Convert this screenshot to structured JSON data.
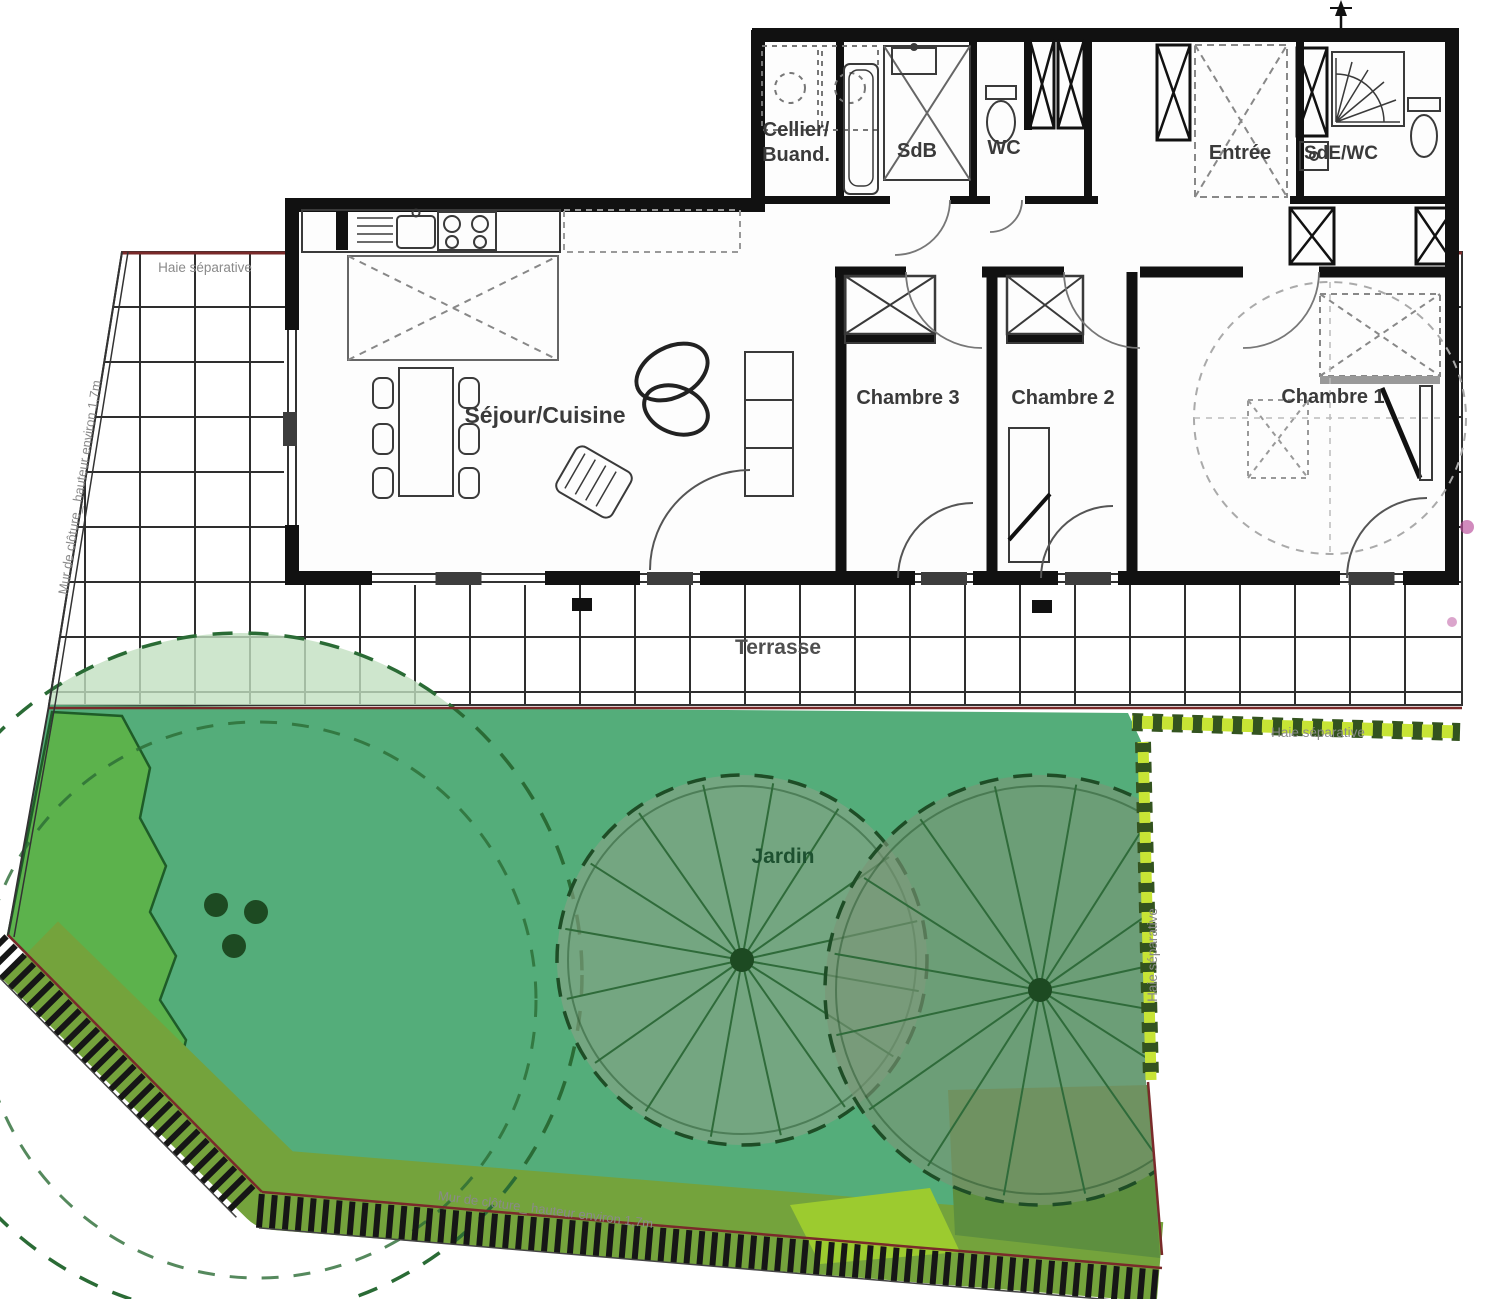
{
  "plan": {
    "labels": {
      "cellier_1": "Cellier/",
      "cellier_2": "Buand.",
      "sdb": "SdB",
      "wc": "WC",
      "entree": "Entrée",
      "sde_wc": "SdE/WC",
      "sejour": "Séjour/Cuisine",
      "chambre3": "Chambre 3",
      "chambre2": "Chambre 2",
      "chambre1": "Chambre 1",
      "terrasse": "Terrasse",
      "jardin": "Jardin",
      "haie": "Haie séparative",
      "mur": "Mur de clôture_ hauteur environ 1,7m"
    },
    "zones": [
      "Cellier/Buand.",
      "SdB",
      "WC",
      "Entrée",
      "SdE/WC",
      "Séjour/Cuisine",
      "Chambre 3",
      "Chambre 2",
      "Chambre 1",
      "Terrasse",
      "Jardin"
    ]
  },
  "colors": {
    "background": "#ffffff",
    "wall": "#111111",
    "fixture": "#3a3a3a",
    "grid_line": "#2e2e2e",
    "boundary_red": "#7a2a2a",
    "lawn": "#54ad7a",
    "lawn_bright": "#5cb24c",
    "canopy_fill": "#c2e0c0",
    "canopy_edge": "#2a6b35",
    "band_olive": "#74a33c",
    "band_dark": "#5d8f3f",
    "patch_yellow": "#9ccb2f",
    "wheel_fill_left": "rgba(140,162,135,0.58)",
    "wheel_fill_right": "rgba(122,148,118,0.62)",
    "wheel_edge": "#1e4d26",
    "spoke": "#2f6b3a",
    "hedge_light": "#c7e435",
    "hedge_dark": "#33531f",
    "bush": "#1d4a22",
    "hatch_stripe": "#161616",
    "label": "#3a3a3a",
    "label_muted": "#8a8a8a",
    "jardin_label": "#1d5130",
    "accent_pink": "#b84b9a"
  }
}
